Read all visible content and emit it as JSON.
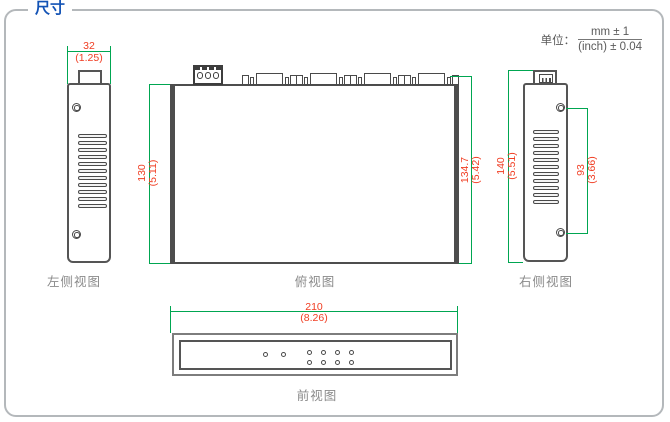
{
  "title": "尺寸",
  "unit": {
    "label": "单位：",
    "numerator": "mm ± 1",
    "denominator": "(inch) ± 0.04"
  },
  "views": {
    "left_side": {
      "label": "左侧视图",
      "width_dim": {
        "mm": "32",
        "inch": "(1.25)"
      }
    },
    "top": {
      "label": "俯视图",
      "depth_dim": {
        "mm": "130",
        "inch": "(5.11)"
      },
      "depth_with_connectors_dim": {
        "mm": "134.7",
        "inch": "(5.42)"
      }
    },
    "right_side": {
      "label": "右侧视图",
      "height_dim": {
        "mm": "140",
        "inch": "(5.51)"
      },
      "screw_span_dim": {
        "mm": "93",
        "inch": "(3.66)"
      }
    },
    "front": {
      "label": "前视图",
      "width_dim": {
        "mm": "210",
        "inch": "(8.26)"
      }
    }
  },
  "colors": {
    "accent_blue": "#1353b5",
    "dimension_red": "#f03d22",
    "dimension_green": "#00a651",
    "outline_gray": "#555555"
  }
}
